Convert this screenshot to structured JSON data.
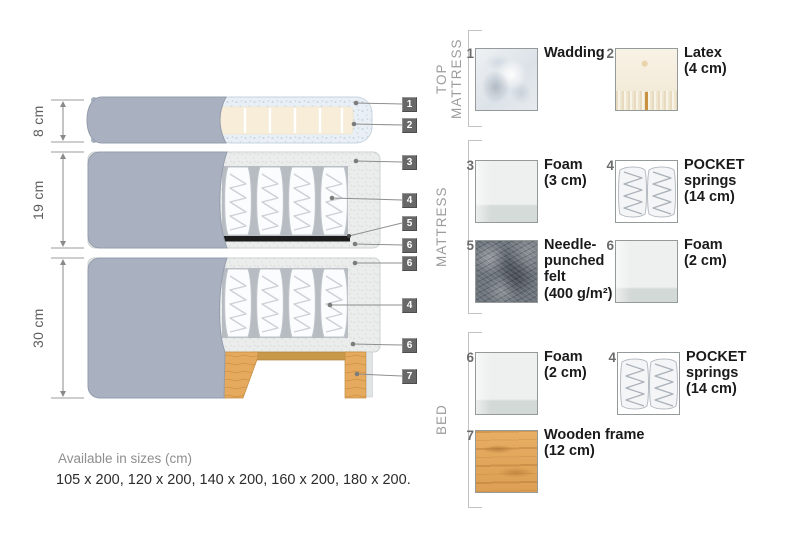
{
  "diagram": {
    "dimensions": [
      {
        "label": "8 cm"
      },
      {
        "label": "19 cm"
      },
      {
        "label": "30 cm"
      }
    ],
    "callouts": [
      {
        "n": "1"
      },
      {
        "n": "2"
      },
      {
        "n": "3"
      },
      {
        "n": "4"
      },
      {
        "n": "5"
      },
      {
        "n": "6"
      },
      {
        "n": "6"
      },
      {
        "n": "4"
      },
      {
        "n": "6"
      },
      {
        "n": "7"
      }
    ]
  },
  "legend": {
    "sections": [
      {
        "title": "TOP MATTRESS",
        "items": [
          {
            "n": "1",
            "name": "Wadding",
            "size": "",
            "texture": "wadding-swatch"
          },
          {
            "n": "2",
            "name": "Latex",
            "size": "(4 cm)",
            "texture": "latex-swatch"
          }
        ]
      },
      {
        "title": "MATTRESS",
        "items": [
          {
            "n": "3",
            "name": "Foam",
            "size": "(3 cm)",
            "texture": "foam-swatch"
          },
          {
            "n": "4",
            "name": "POCKET springs",
            "size": "(14 cm)",
            "texture": "pocket-springs-swatch"
          },
          {
            "n": "5",
            "name": "Needle-punched felt",
            "size": "(400 g/m²)",
            "texture": "felt-swatch"
          },
          {
            "n": "6",
            "name": "Foam",
            "size": "(2 cm)",
            "texture": "foam-swatch"
          }
        ]
      },
      {
        "title": "BED",
        "items": [
          {
            "n": "6",
            "name": "Foam",
            "size": "(2 cm)",
            "texture": "foam-swatch"
          },
          {
            "n": "4",
            "name": "POCKET springs",
            "size": "(14 cm)",
            "texture": "pocket-springs-swatch"
          },
          {
            "n": "7",
            "name": "Wooden frame",
            "size": "(12 cm)",
            "texture": "wood-swatch"
          }
        ]
      }
    ]
  },
  "footer": {
    "sizes_title": "Available in sizes (cm)",
    "sizes_list": "105 x 200, 120 x 200, 140 x 200, 160 x 200, 180 x 200."
  },
  "colors": {
    "fabric_grey": "#a9b1c0",
    "wadding_blue": "#e9eff5",
    "latex_cream": "#f6efe0",
    "felt_grey": "#6d737b",
    "wood_tan": "#e2a55c",
    "callout_badge": "#686868",
    "felt_bar_black": "#1c1c1c"
  }
}
